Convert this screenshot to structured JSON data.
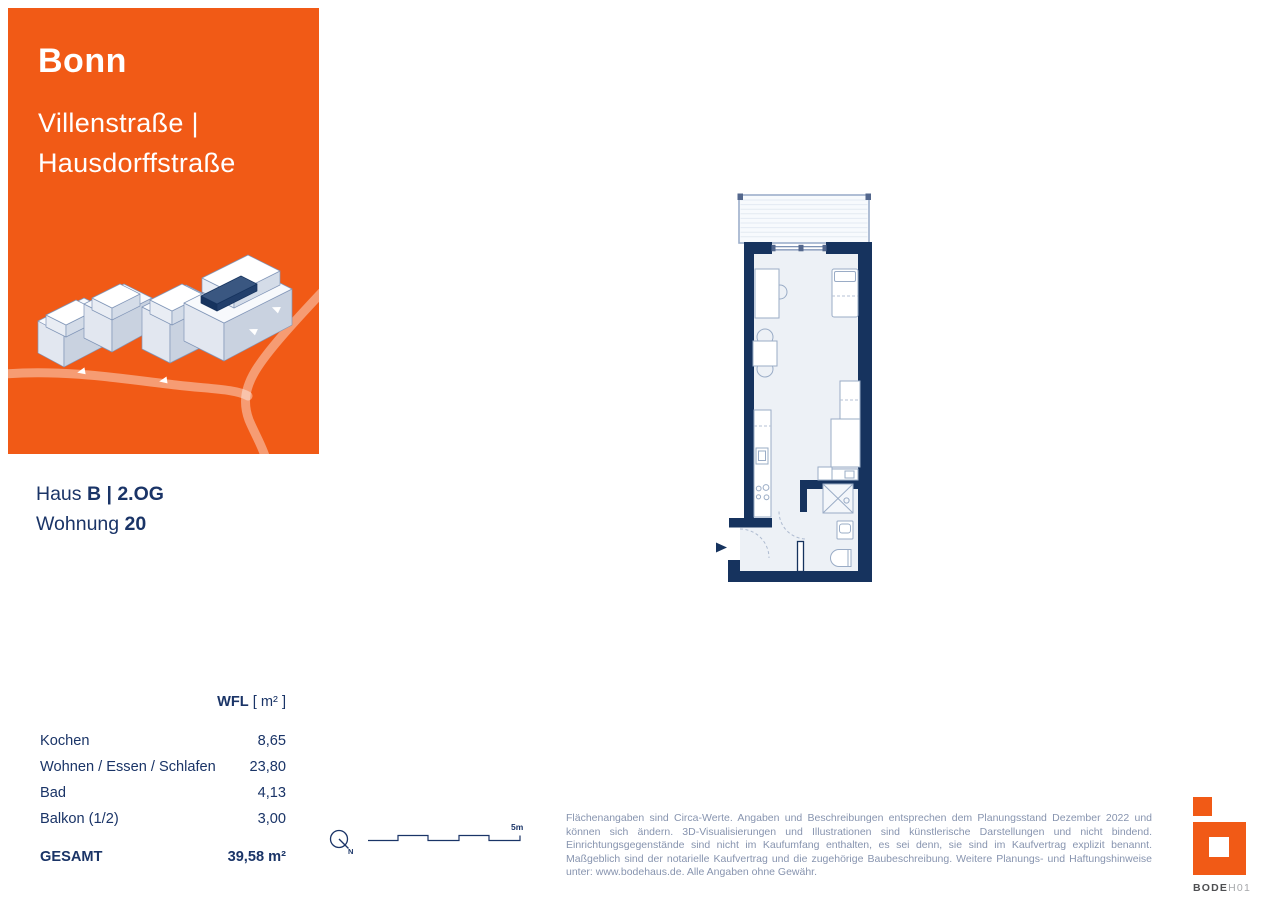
{
  "colors": {
    "orange": "#F15A16",
    "navy_text": "#1A3467",
    "wall_navy": "#16335E",
    "road_tint": "rgba(255,255,255,0.40)",
    "muted_blue": "#8794AF",
    "furniture_line": "#9AACC6"
  },
  "header": {
    "city": "Bonn",
    "street_line1": "Villenstraße |",
    "street_line2": "Hausdorffstraße"
  },
  "unit": {
    "haus_label": "Haus ",
    "haus_value": "B | 2.OG",
    "wohnung_label": "Wohnung ",
    "wohnung_value": "20"
  },
  "area_table": {
    "header_bold": "WFL",
    "header_rest": " [ m² ]",
    "rows": [
      {
        "label": "Kochen",
        "value": "8,65"
      },
      {
        "label": "Wohnen / Essen / Schlafen",
        "value": "23,80"
      },
      {
        "label": "Bad",
        "value": "4,13"
      },
      {
        "label": "Balkon (1/2)",
        "value": "3,00"
      }
    ],
    "total_label": "GESAMT",
    "total_value": "39,58 m²"
  },
  "plan": {
    "north_label": "N",
    "scale_label": "5m"
  },
  "disclaimer": "Flächenangaben sind Circa-Werte. Angaben und Beschreibungen entsprechen dem Planungsstand Dezember 2022 und können sich ändern. 3D-Visualisierungen und Illustrationen sind künstlerische Darstellungen und nicht bindend. Einrichtungsgegenstände sind nicht im Kaufumfang enthalten, es sei denn, sie sind im Kaufvertrag explizit benannt. Maßgeblich sind der notarielle Kaufvertrag und die zugehörige Baubeschreibung. Weitere Planungs- und Haftungshinweise unter: www.bodehaus.de. Alle Angaben ohne Gewähr.",
  "logo": {
    "text_bold": "BODE",
    "text_light": "H01"
  }
}
